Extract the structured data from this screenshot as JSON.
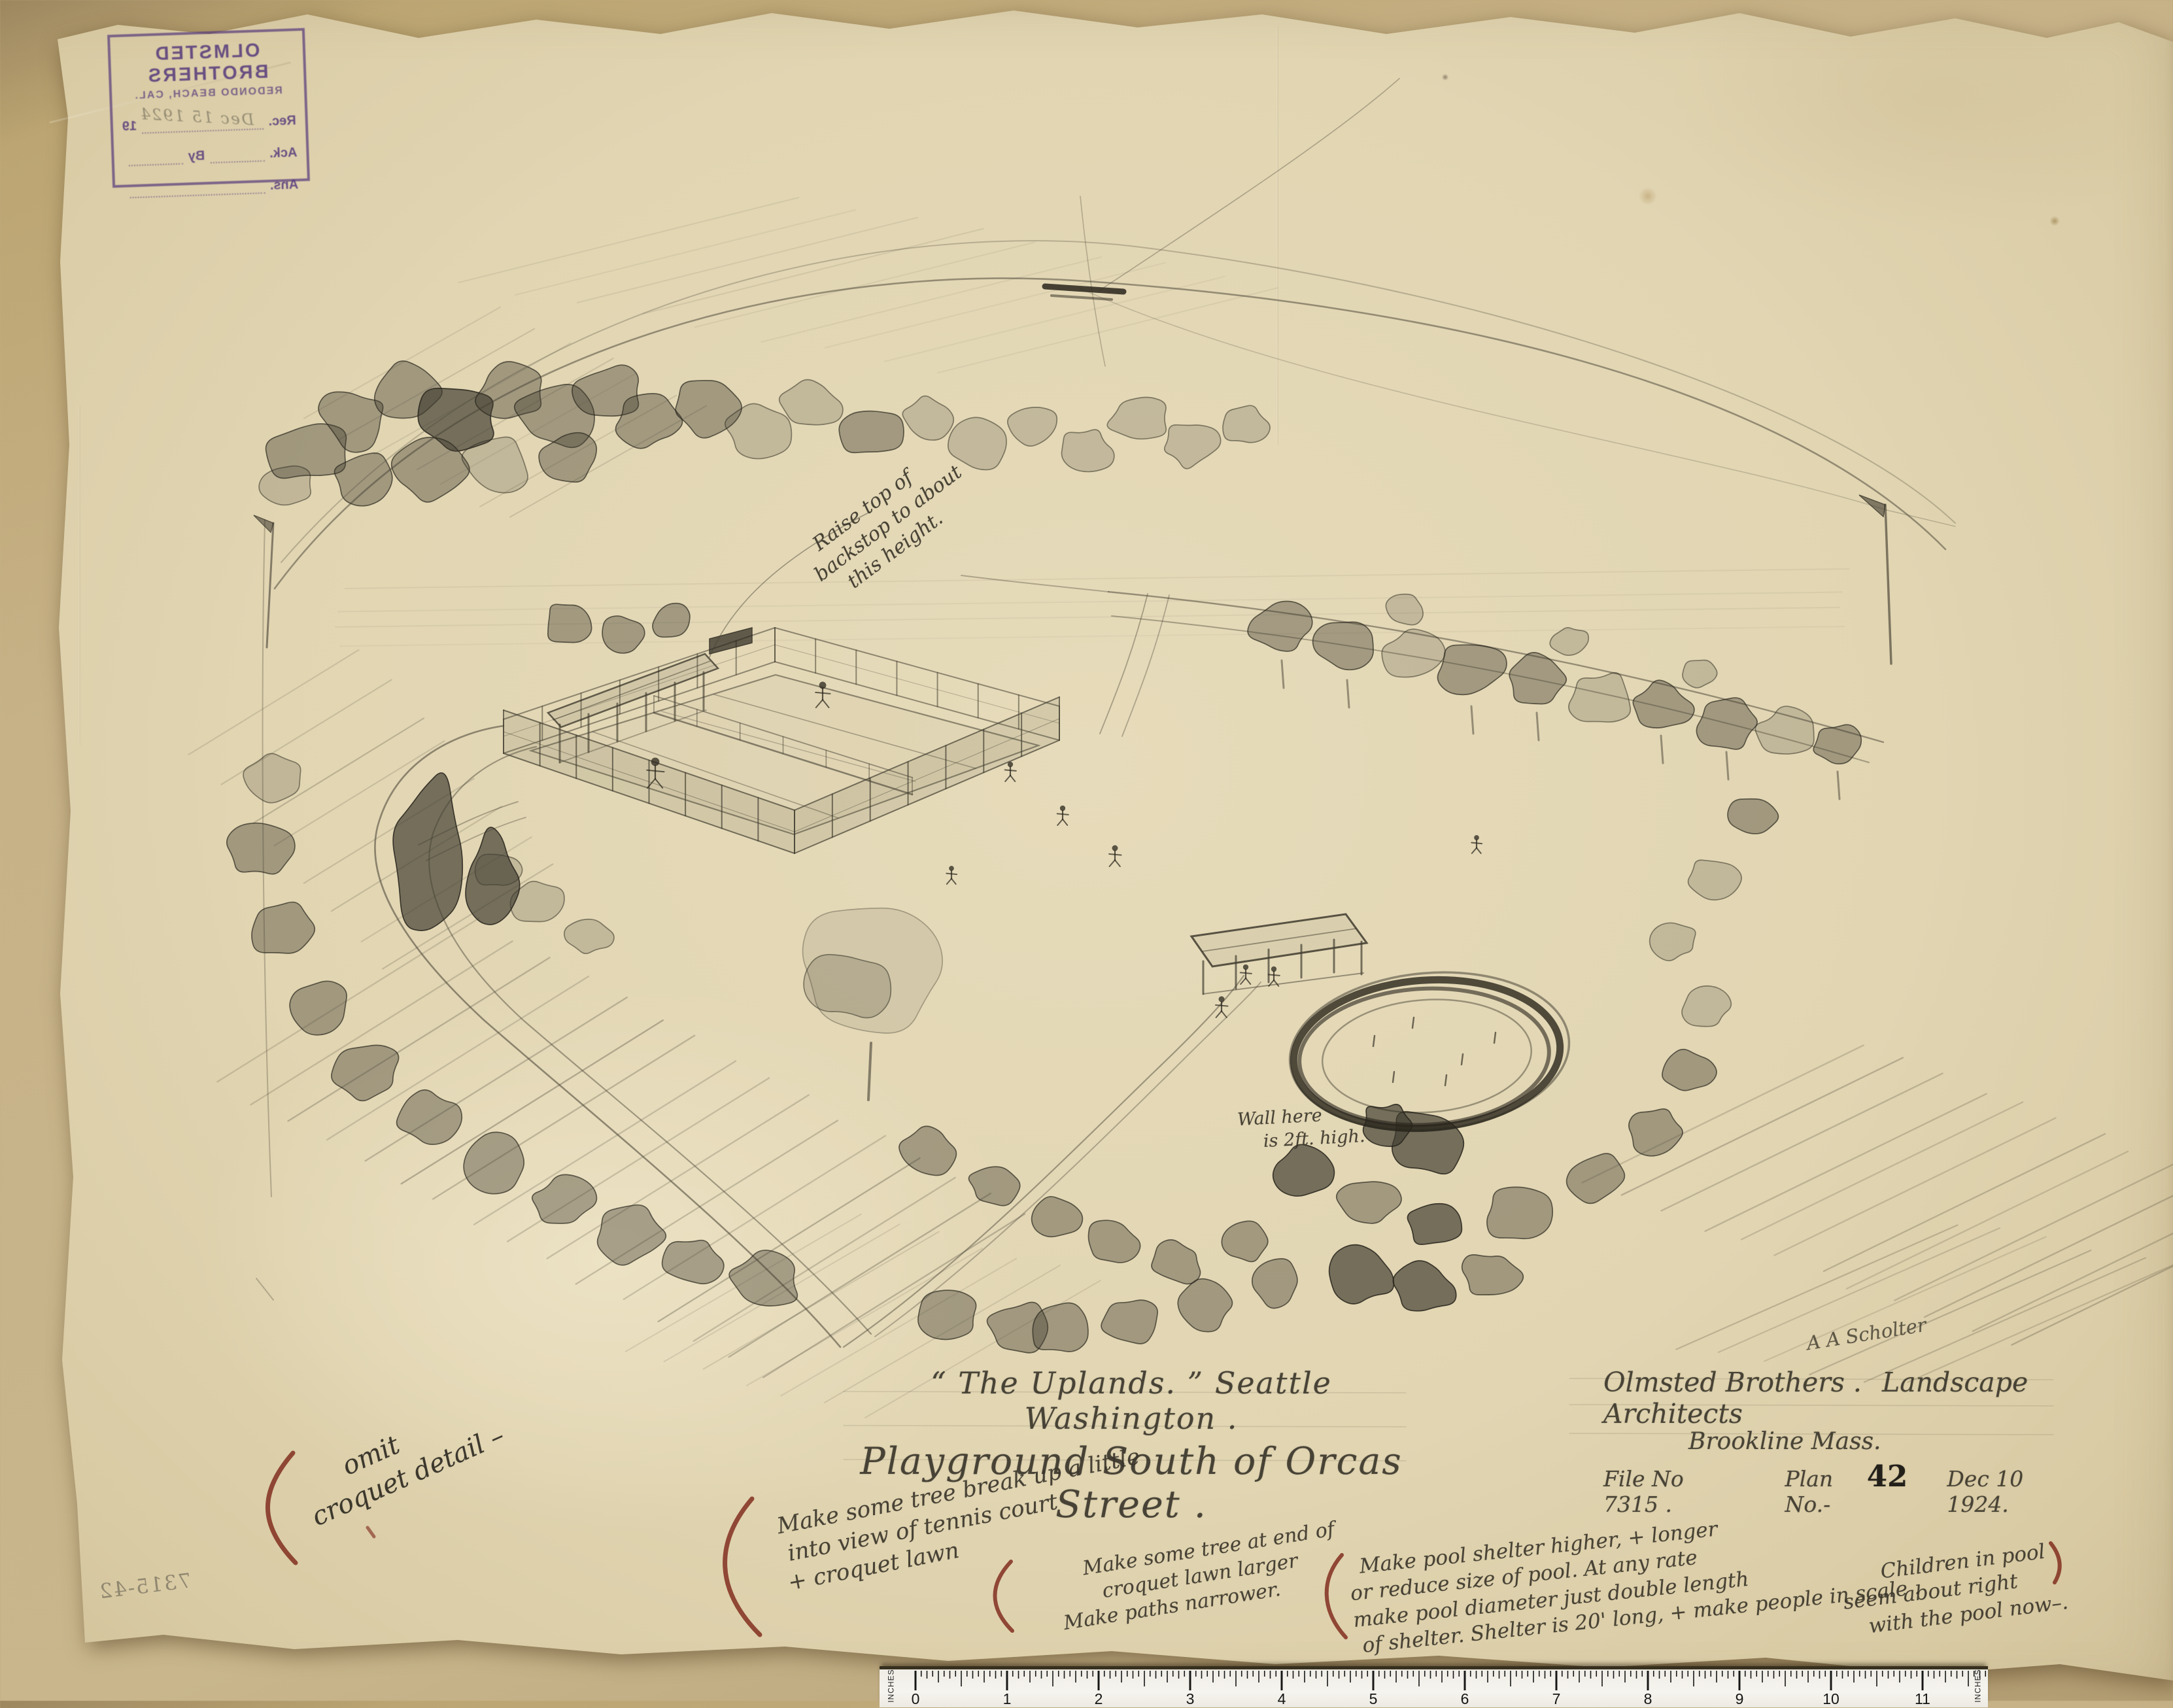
{
  "stamp": {
    "org": "OLMSTED BROTHERS",
    "location": "REDONDO BEACH, CAL.",
    "rec_label": "Rec.",
    "rec_year": "19",
    "rec_value": "Dec 15 1924",
    "ack_label": "Ack.",
    "by_label": "By",
    "ans_label": "Ans."
  },
  "perspective_note": [
    "Raise top of",
    "backstop to about",
    "this height."
  ],
  "wall_note": [
    "Wall here",
    "is 2ft. high."
  ],
  "title": {
    "line1": "“ The Uplands. ”  Seattle Washington .",
    "line2": "Playground South of Orcas Street ."
  },
  "credit": {
    "firm": "Olmsted Brothers .",
    "profession": "Landscape Architects",
    "address": "Brookline  Mass.",
    "file": "File No 7315 .",
    "plan_label": "Plan No.-",
    "plan_number": "42",
    "date": "Dec 10 1924."
  },
  "signature": "A A Scholter",
  "corner_number": "7315-42",
  "margin_notes": {
    "omit": [
      "omit",
      "croquet detail –"
    ],
    "tree_break": [
      "Make some tree break up a little",
      "into view of tennis court",
      "+ croquet lawn"
    ],
    "tree_end": [
      "Make some tree at end of",
      "croquet lawn larger",
      "Make paths narrower."
    ],
    "pool_shelter": [
      "Make pool shelter higher, + longer",
      "or reduce size of pool.    At any rate",
      "make pool diameter just double length",
      "of shelter.      Shelter is 20' long, + make people in scale ."
    ],
    "children": [
      "Children in pool",
      "seem about right",
      "with the pool now–."
    ]
  },
  "ruler": {
    "unit_label": "INCHES",
    "numbers": [
      "0",
      "1",
      "2",
      "3",
      "4",
      "5",
      "6",
      "7",
      "8",
      "9",
      "10",
      "11"
    ]
  },
  "colors": {
    "paper": "#e1d5b2",
    "backing": "#c9b68c",
    "graphite": "#454033",
    "dark_ink": "#29251c",
    "stamp_purple": "#583c7c",
    "red_pencil": "#7c2417"
  }
}
